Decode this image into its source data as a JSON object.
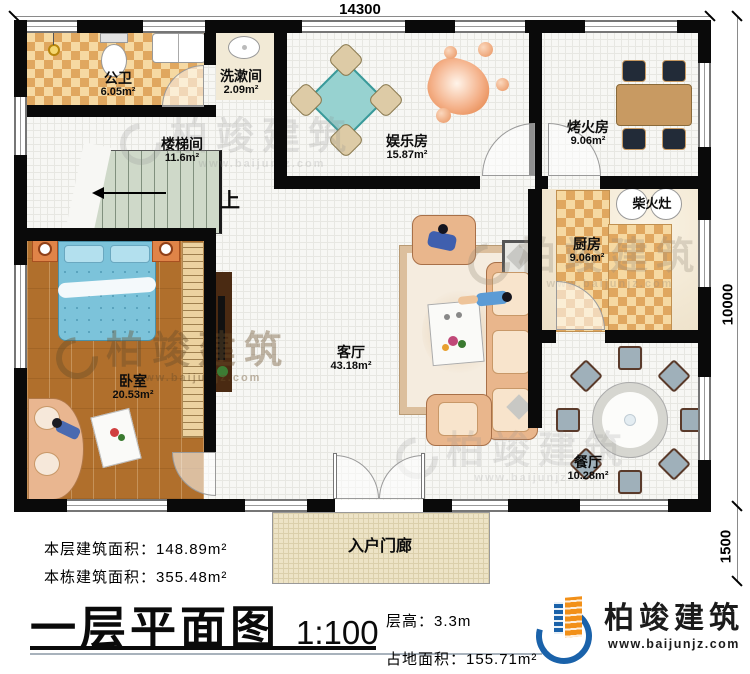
{
  "dimensions": {
    "top": "14300",
    "right_upper": "10000",
    "right_lower": "1500"
  },
  "rooms": {
    "gongwei": {
      "name": "公卫",
      "area": "6.05m²"
    },
    "xishujian": {
      "name": "洗漱间",
      "area": "2.09m²"
    },
    "loutijian": {
      "name": "楼梯间",
      "area": "11.6m²"
    },
    "yulefang": {
      "name": "娱乐房",
      "area": "15.87m²"
    },
    "kaohuofang": {
      "name": "烤火房",
      "area": "9.06m²"
    },
    "chaihuozao": {
      "name": "柴火灶"
    },
    "chufang": {
      "name": "厨房",
      "area": "9.06m²"
    },
    "woshi": {
      "name": "卧室",
      "area": "20.53m²"
    },
    "keting": {
      "name": "客厅",
      "area": "43.18m²"
    },
    "canting": {
      "name": "餐厅",
      "area": "10.28m²"
    },
    "porch": {
      "name": "入户门廊"
    },
    "stairs": {
      "up": "上"
    }
  },
  "info": {
    "floor_area_label": "本层建筑面积：",
    "floor_area_value": "148.89m²",
    "building_area_label": "本栋建筑面积：",
    "building_area_value": "355.48m²",
    "title": "一层平面图",
    "scale": "1:100",
    "height_label": "层高：",
    "height_value": "3.3m",
    "land_label": "占地面积：",
    "land_value": "155.71m²"
  },
  "logo": {
    "name": "柏竣建筑",
    "url": "www.baijunjz.com"
  },
  "watermark": {
    "name": "柏竣建筑",
    "url": "www.baijunjz.com"
  },
  "colors": {
    "wall": "#0a0a0a",
    "brand_blue": "#1a62aa",
    "brand_orange": "#f29018",
    "checker_tan": "#e0a75f",
    "checker_cream": "#f6d9a2",
    "wood": "#b06f2c",
    "stair_green": "#cfd9c9",
    "porch_beige": "#ede3c6",
    "mahjong_teal": "#97d2d0",
    "bed_blue": "#7cc3da"
  }
}
